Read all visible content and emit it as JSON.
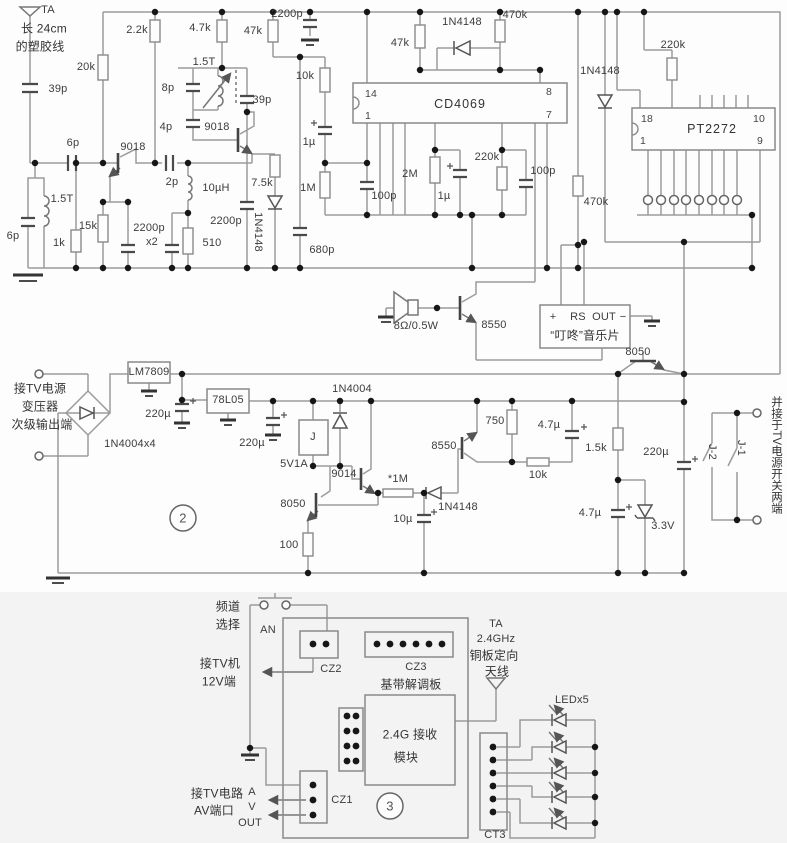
{
  "t": {
    "ta1": "TA",
    "ta1b": "长 24cm",
    "ta1c": "的塑胶线",
    "c39p_1": "39p",
    "c6p_1": "6p",
    "l15t_1": "1.5T",
    "c6p_2": "6p",
    "r1k": "1k",
    "r15k": "15k",
    "r20k": "20k",
    "r2k2": "2.2k",
    "q9018_1": "9018",
    "c2p": "2p",
    "c2200p_x2": "2200p",
    "x2": "x2",
    "r510": "510",
    "l10uh": "10µH",
    "c4p": "4p",
    "c8p": "8p",
    "l15t_2": "1.5T",
    "q9018_2": "9018",
    "c39p_2": "39p",
    "r7k5": "7.5k",
    "d4148_1": "1N4148",
    "c2200p_2": "2200p",
    "r4k7": "4.7k",
    "r47k_1": "47k",
    "c2200p_3": "2200p",
    "c680p": "680p",
    "r10k_1": "10k",
    "c1u_1": "1µ",
    "r1m": "1M",
    "c100p_1": "100p",
    "p14": "14",
    "p1": "1",
    "cd4069": "CD4069",
    "p8": "8",
    "p7": "7",
    "r47k_2": "47k",
    "d4148_2": "1N4148",
    "r470k_1": "470k",
    "r2m": "2M",
    "c1u_2": "1µ",
    "r220k_1": "220k",
    "c100p_2": "100p",
    "d4148_3": "1N4148",
    "r470k_2": "470k",
    "r220k_2": "220k",
    "p18": "18",
    "p1b": "1",
    "pt2272": "PT2272",
    "p10": "10",
    "p9": "9",
    "spk": "8Ω/0.5W",
    "q8550_1": "8550",
    "mplus": "+",
    "mrs": "RS",
    "mout": "OUT",
    "mminus": "−",
    "music": "“叮咚”音乐片",
    "q8050_3": "8050",
    "pw1": "接TV电源",
    "pw2": "变压器",
    "pw3": "次级输出端",
    "lm7809": "LM7809",
    "bridge": "1N4004x4",
    "c220u_1": "220µ",
    "u78l05": "78L05",
    "c220u_2": "220µ",
    "d4004": "1N4004",
    "relay": "J",
    "v5v1a": "5V1A",
    "q9014": "9014",
    "r1m_s": "*1M",
    "q8550_2": "8550",
    "d4148_4": "1N4148",
    "c10u": "10µ",
    "q8050_2": "8050",
    "r100": "100",
    "r750": "750",
    "r10k_2": "10k",
    "c4u7_1": "4.7µ",
    "r1k5": "1.5k",
    "c4u7_2": "4.7µ",
    "z3v3": "3.3V",
    "c220u_3": "220µ",
    "sec2": "2",
    "j2": "J-2",
    "j1": "J-1",
    "pw4": "并接于TV电源开关两端",
    "ch1": "频道",
    "ch2": "选择",
    "an": "AN",
    "tv12_1": "接TV机",
    "tv12_2": "12V端",
    "cz2": "CZ2",
    "cz3": "CZ3",
    "bb": "基带解调板",
    "mod1": "2.4G 接收",
    "mod2": "模块",
    "cz1": "CZ1",
    "sec3": "3",
    "av1": "接TV电路",
    "av2": "AV端口",
    "a": "A",
    "v": "V",
    "out": "OUT",
    "ta2a": "TA",
    "ta2b": "2.4GHz",
    "ta2c": "铜板定向",
    "ta2d": "天线",
    "led5": "LEDx5",
    "ct3": "CT3"
  }
}
